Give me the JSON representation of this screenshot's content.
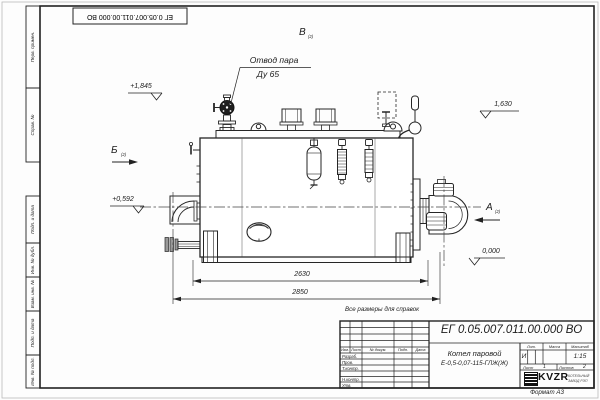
{
  "frame": {
    "stamp_top": "ЕГ 0.05.007.011.00.000  ВО",
    "margin_cells": [
      "Перв. примен.",
      "Справ. №",
      "Подп. и дата",
      "Инв. № дубл.",
      "Взам. инв. №",
      "Подп. и дата",
      "Инв. № подл."
    ],
    "format_note": "Формат А3"
  },
  "drawing": {
    "callout_steam_line1": "Отвод пара",
    "callout_steam_line2": "Ду 65",
    "note": "Все размеры для справок",
    "elevations": {
      "e1": "+1,845",
      "e2": "+0,592",
      "e3": "1,630",
      "e4": "0,000"
    },
    "dimensions": {
      "d1": "2630",
      "d2": "2850"
    },
    "views": {
      "a": "А",
      "b": "Б",
      "v": "В",
      "ref": "(2)"
    }
  },
  "title_block": {
    "doc_number": "ЕГ 0.05.007.011.00.000  ВО",
    "name_line1": "Котел паровой",
    "name_line2": "Е-0,5-0,07-115-ГЛЖ(Ж)",
    "col_izm": "Изм.",
    "col_list": "Лист",
    "col_doc": "№ докум.",
    "col_sign": "Подп.",
    "col_date": "Дата",
    "row_razrab": "Разраб.",
    "row_prov": "Пров.",
    "row_tkontr": "Т.контр.",
    "row_nkontr": "Н.контр.",
    "row_utv": "Утв.",
    "lit_label": "Лит.",
    "lit_value": "И",
    "mass_label": "Масса",
    "scale_label": "Масштаб",
    "scale_value": "1:15",
    "sheet_label": "Лист",
    "sheet_value": "1",
    "sheets_label": "Листов",
    "sheets_value": "2",
    "company_logo": "KVZR",
    "company_line1": "КОТЕЛЬНЫЙ",
    "company_line2": "ЗАВОД РЭП"
  }
}
